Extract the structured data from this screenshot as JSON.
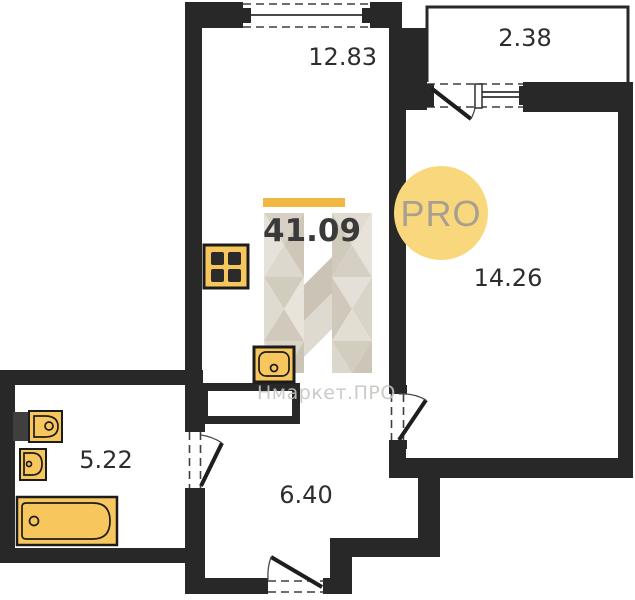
{
  "rooms": {
    "kitchen_living": {
      "area": "12.83"
    },
    "balcony": {
      "area": "2.38"
    },
    "bedroom": {
      "area": "14.26"
    },
    "bathroom": {
      "area": "5.22"
    },
    "hallway": {
      "area": "6.40"
    }
  },
  "total_area": {
    "value": "41.09"
  },
  "watermark": {
    "badge": "PRO",
    "brand": "Нмаркет.ПРО",
    "letter": "Н"
  },
  "colors": {
    "wall": "#282828",
    "accent_bar": "#f2b844",
    "fixture_fill": "#f7c75e",
    "badge_fill": "#f9d77c",
    "badge_text": "#a89f90",
    "brand_text": "#c7c5c0",
    "label_text": "#2d2d2d"
  }
}
